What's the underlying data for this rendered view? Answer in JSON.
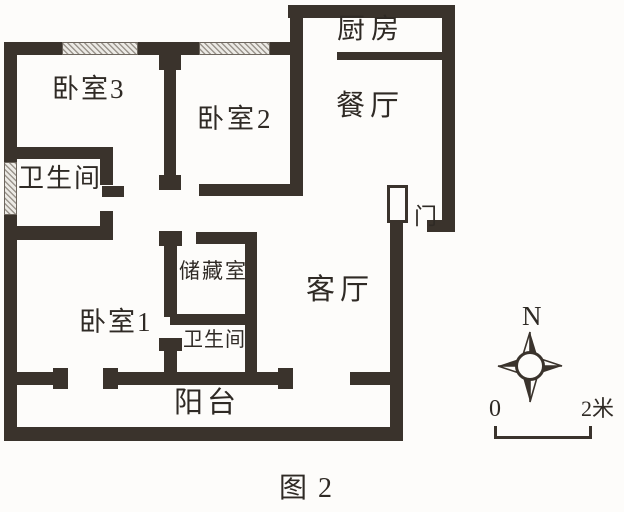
{
  "figure": {
    "caption": "图 2"
  },
  "colors": {
    "wall": "#3a332c",
    "background": "#fdfcfa",
    "window_hatch_line": "#9b958d",
    "window_hatch_fill": "#eceae5"
  },
  "rooms": [
    {
      "id": "kitchen",
      "label": "厨房"
    },
    {
      "id": "dining-room",
      "label": "餐厅"
    },
    {
      "id": "bedroom-3",
      "label": "卧室3"
    },
    {
      "id": "bedroom-2",
      "label": "卧室2"
    },
    {
      "id": "bathroom-north",
      "label": "卫生间"
    },
    {
      "id": "storage-room",
      "label": "储藏室"
    },
    {
      "id": "bedroom-1",
      "label": "卧室1"
    },
    {
      "id": "bathroom-south",
      "label": "卫生间"
    },
    {
      "id": "living-room",
      "label": "客厅"
    },
    {
      "id": "balcony",
      "label": "阳台"
    }
  ],
  "annotations": {
    "entrance_door": "门",
    "compass_north": "N",
    "scale_start": "0",
    "scale_end": "2米"
  }
}
